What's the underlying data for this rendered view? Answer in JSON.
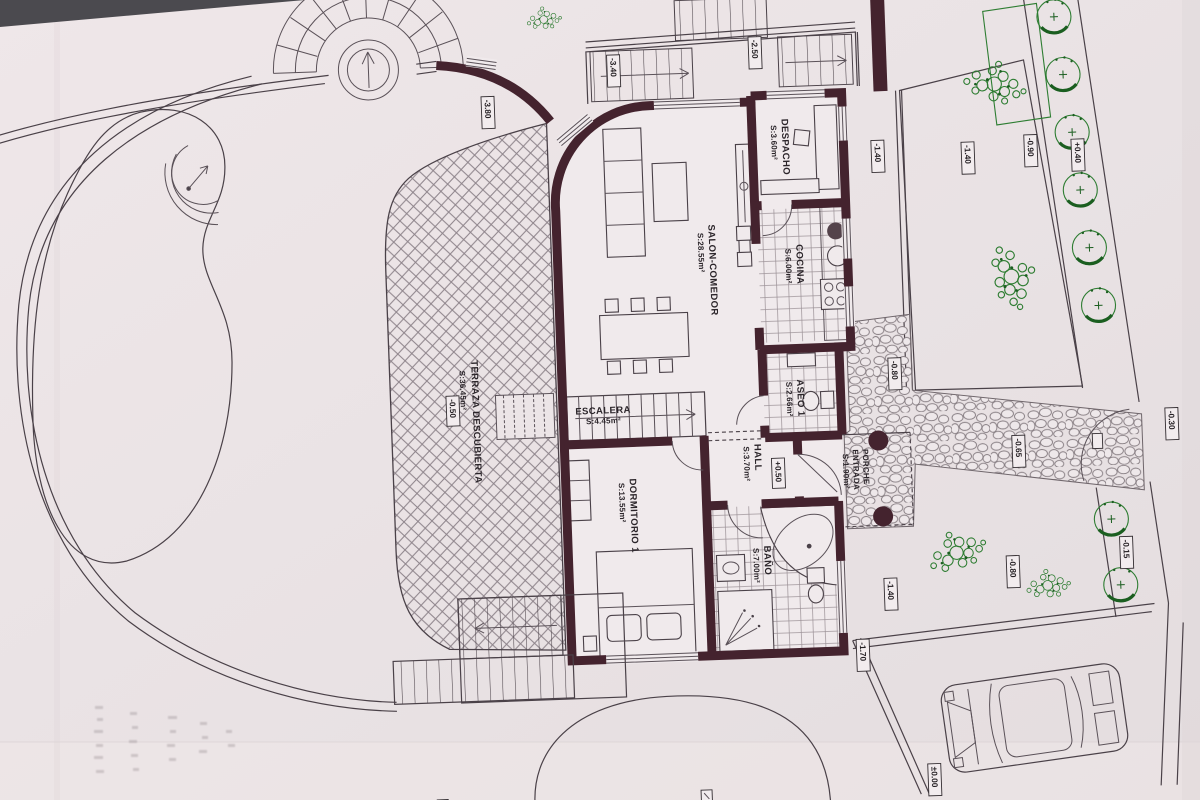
{
  "title": "Scanned architectural floor plan (ground floor with garden, pool and garage)",
  "colors": {
    "paper": "#e9e2e4",
    "ink": "#4a4148",
    "wall": "#44232e",
    "green": "#2e7d32",
    "green_dark": "#1b5e20"
  },
  "rooms": {
    "despacho": {
      "name": "DESPACHO",
      "area": "S:3.60m²"
    },
    "salon": {
      "name": "SALON-COMEDOR",
      "area": "S:28.55m²"
    },
    "cocina": {
      "name": "COCINA",
      "area": "S:6.00m²"
    },
    "escalera": {
      "name": "ESCALERA",
      "area": "S:4.45m²"
    },
    "aseo": {
      "name": "ASEO 1",
      "area": "S:2.66m²"
    },
    "hall": {
      "name": "HALL",
      "area": "S:3.70m²",
      "level": "+0.50"
    },
    "dormitorio": {
      "name": "DORMITORIO 1",
      "area": "S:13.55m²"
    },
    "bano": {
      "name": "BAÑO",
      "area": "S:7.00m²"
    },
    "porche": {
      "name": "PORCHE",
      "name2": "ENTRADA",
      "area": "S:1.90m²"
    },
    "terraza": {
      "name": "TERRAZA DESCUBIERTA",
      "area": "S:36.45m²",
      "level": "-0.50"
    }
  },
  "levels": {
    "upper_terrace_left": "-3.80",
    "upper_terrace_mid": "-3.40",
    "top_stairs": "-2.50",
    "courtyard_a": "-1.40",
    "courtyard_b": "-1.40",
    "fence_strip_a": "-0.90",
    "fence_strip_b": "+0.40",
    "entry_path": "-0.80",
    "street_edge": "-0.30",
    "driveway": "-0.65",
    "garden_right_a": "-0.80",
    "garden_right_b": "-0.15",
    "garden_right_c": "-1.40",
    "garage_side": "-1.70",
    "garage_floor": "±0.00"
  }
}
